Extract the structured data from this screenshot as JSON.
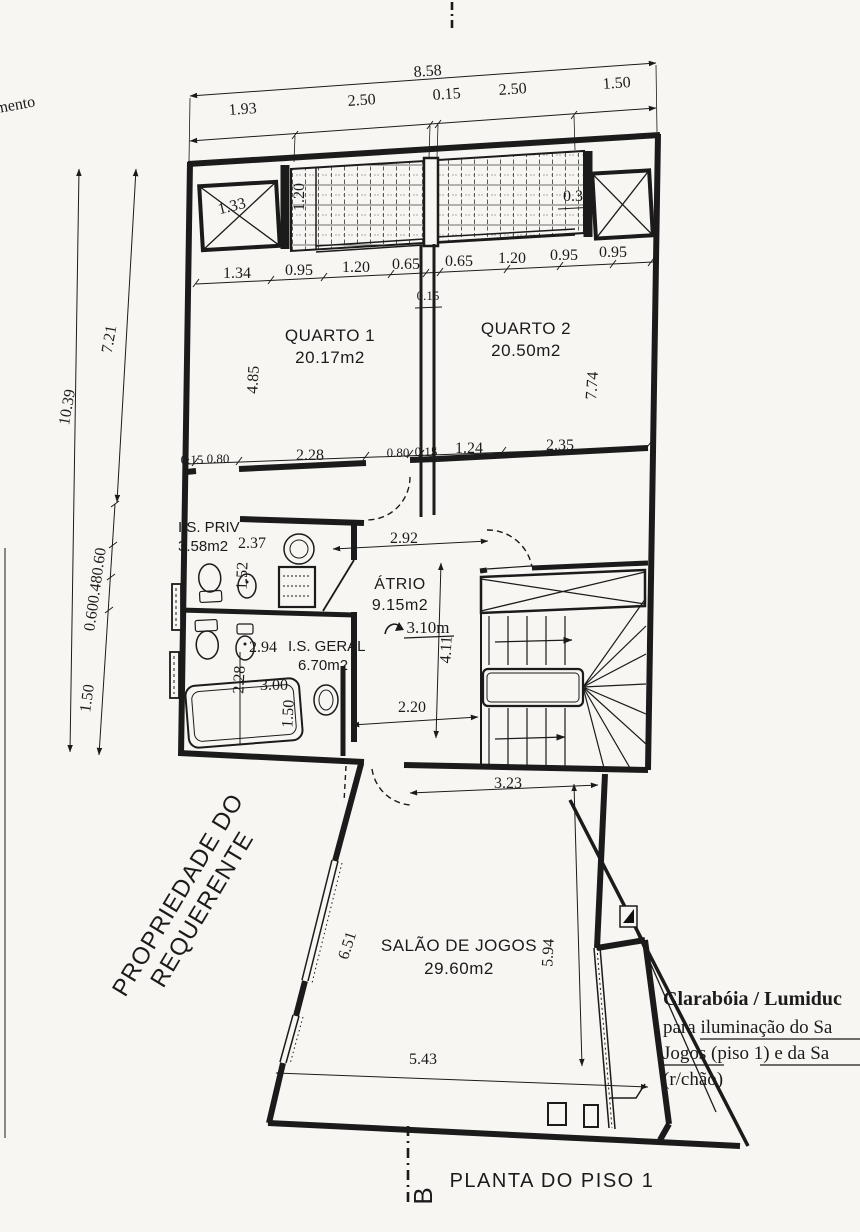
{
  "page": {
    "title": "PLANTA DO PISO 1",
    "edge_note": "imento",
    "property_note_line1": "PROPRIEDADE DO",
    "property_note_line2": "REQUERENTE",
    "section_marker": "B"
  },
  "annotation": {
    "line1": "Clarabóia / Lumiduc",
    "line2": "para iluminação do Sa",
    "line3": "Jogos (piso 1) e da Sa",
    "line4": "(r/chão)"
  },
  "rooms": {
    "quarto1": {
      "name": "QUARTO 1",
      "area": "20.17m2"
    },
    "quarto2": {
      "name": "QUARTO 2",
      "area": "20.50m2"
    },
    "atrio": {
      "name": "ÁTRIO",
      "area": "9.15m2",
      "ceiling": "3.10m"
    },
    "is_priv": {
      "name": "I.S. PRIV",
      "area": "3.58m2"
    },
    "is_geral": {
      "name": "I.S. GERAL",
      "area": "6.70m2"
    },
    "salao": {
      "name": "SALÃO DE JOGOS",
      "area": "29.60m2"
    }
  },
  "dims": {
    "top_total": "8.58",
    "top_1": "1.93",
    "top_2": "2.50",
    "top_3": "0.15",
    "top_4": "2.50",
    "top_5": "1.50",
    "box_left": "1.33",
    "strip_left": "1.20",
    "box_right": "0.30",
    "win_1": "1.34",
    "win_2": "0.95",
    "win_3": "1.20",
    "win_4": "0.65",
    "win_5": "0.65",
    "win_6": "1.20",
    "win_7": "0.95",
    "win_8": "0.95",
    "wall_mid": "0.15",
    "q1_depth": "4.85",
    "q2_depth": "7.74",
    "left_total": "10.39",
    "left_upper": "7.21",
    "left_mid": "0.600.480.60",
    "left_lower": "1.50",
    "mid_1": "0.15",
    "mid_2": "0.80",
    "mid_3": "2.28",
    "mid_4": "0.80",
    "mid_5": "0.15",
    "mid_6": "1.24",
    "mid_7": "2.35",
    "priv_w": "2.37",
    "priv_h": "1.52",
    "atrio_w": "2.92",
    "atrio_d": "4.11",
    "corridor": "2.20",
    "geral_w": "2.94",
    "geral_h": "2.28",
    "tub_w": "3.00",
    "tub_h": "1.50",
    "salao_top": "3.23",
    "salao_left": "6.51",
    "salao_right": "5.94",
    "salao_bottom": "5.43"
  }
}
